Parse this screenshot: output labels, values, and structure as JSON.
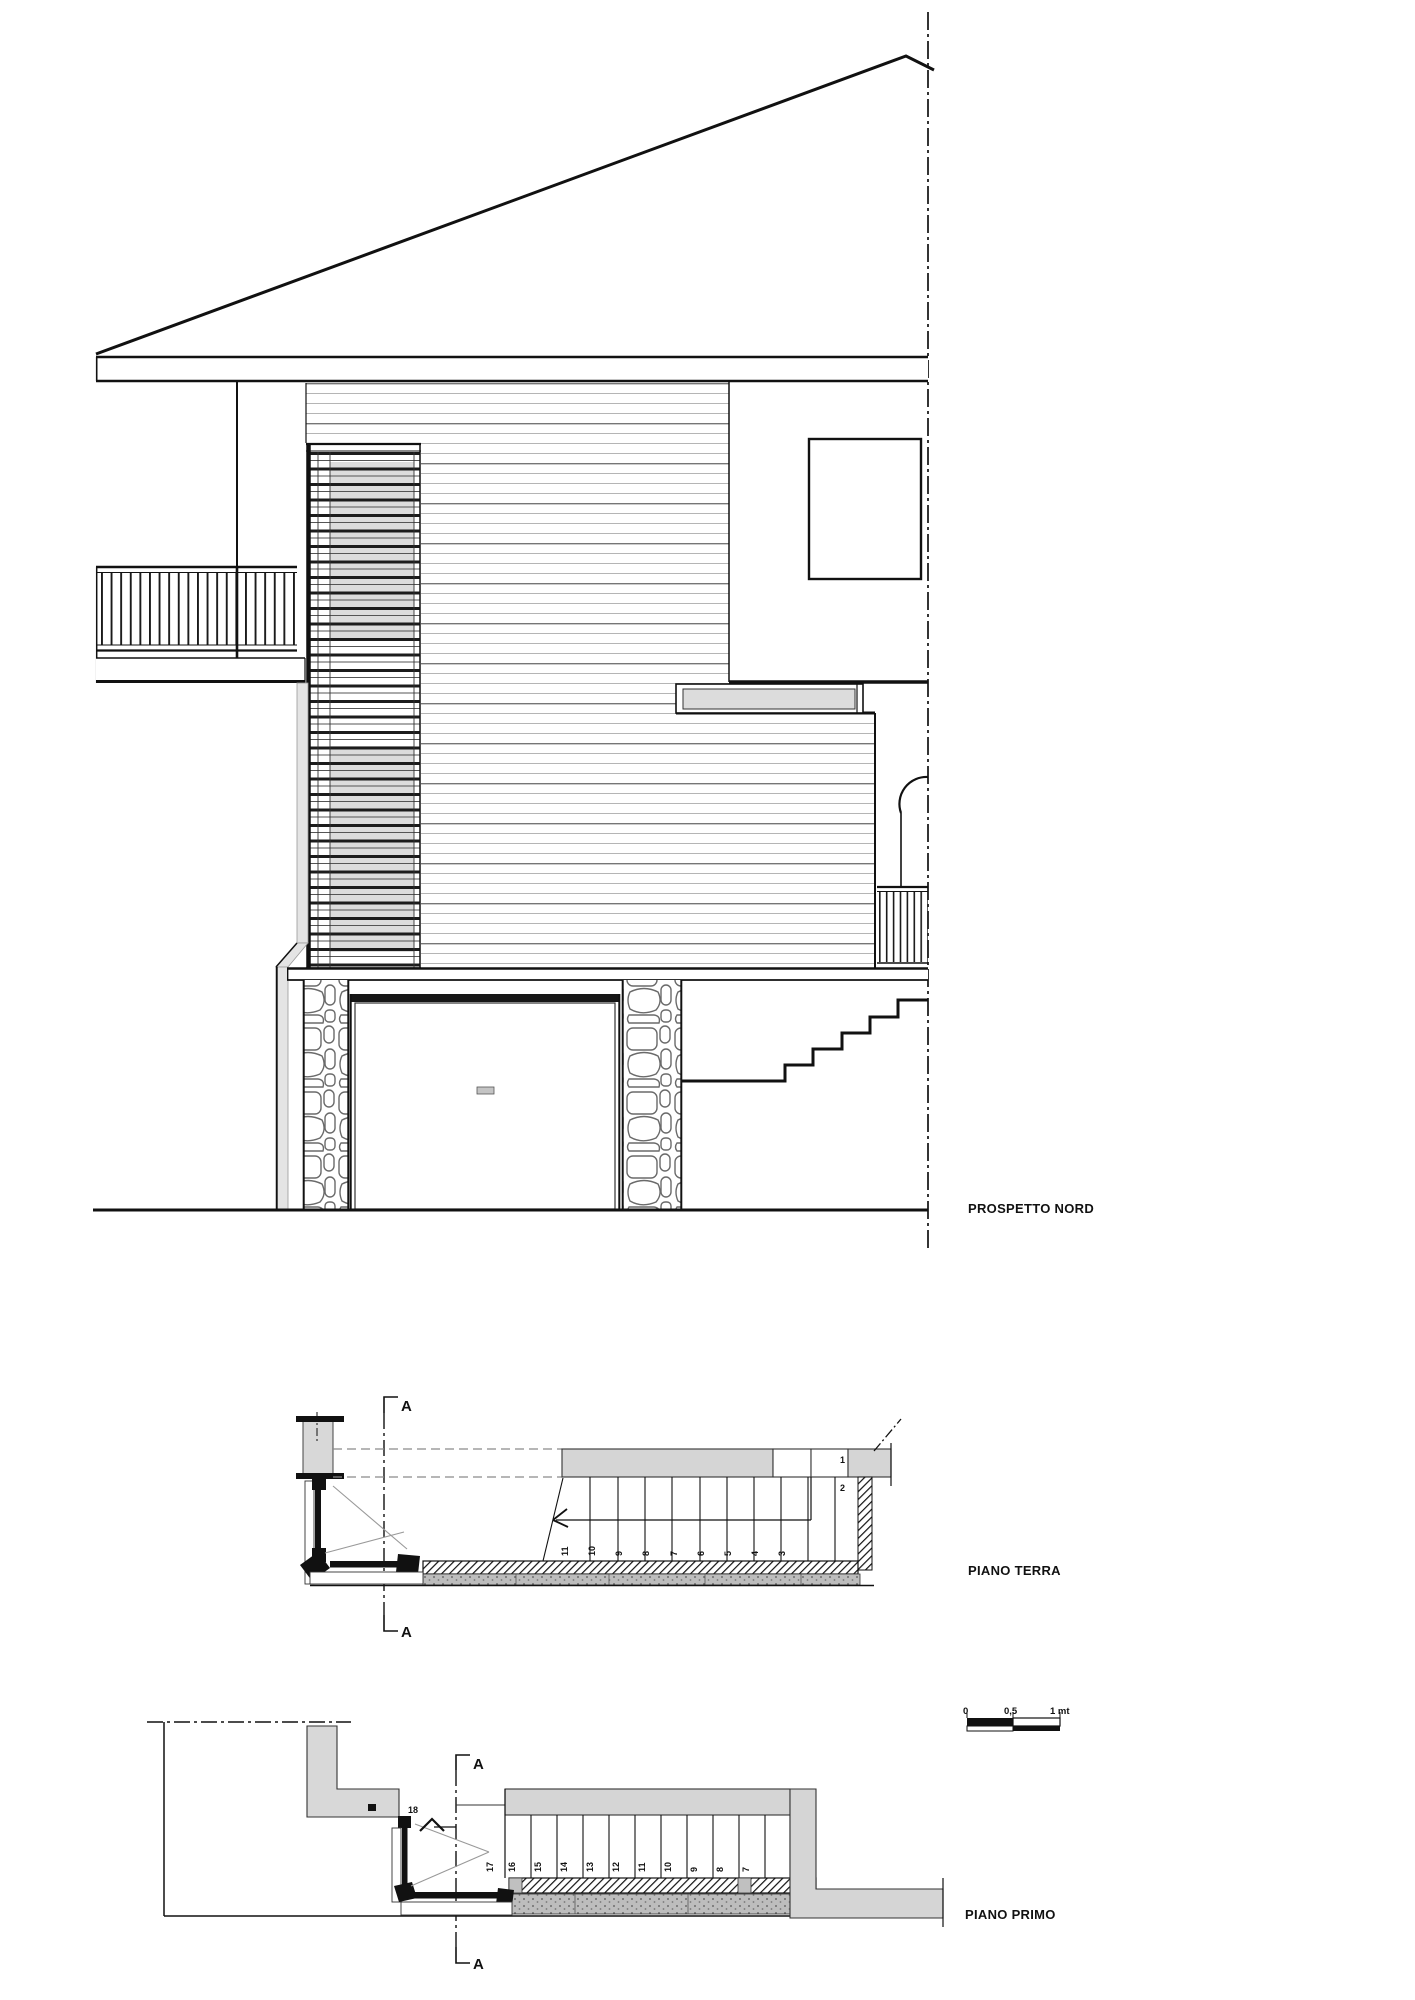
{
  "drawing": {
    "elevation": {
      "label": "PROSPETTO NORD"
    },
    "plan_ground": {
      "label": "PIANO TERRA",
      "section_marker": "A",
      "top_numbers": [
        "1",
        "2"
      ],
      "step_numbers": [
        "11",
        "10",
        "9",
        "8",
        "7",
        "6",
        "5",
        "4",
        "3"
      ]
    },
    "plan_first": {
      "label": "PIANO PRIMO",
      "section_marker": "A",
      "top_step": "18",
      "step_numbers": [
        "17",
        "16",
        "15",
        "14",
        "13",
        "12",
        "11",
        "10",
        "9",
        "8",
        "7"
      ]
    },
    "scale_bar": {
      "zero": "0",
      "half": "0,5",
      "one": "1 mt"
    },
    "colors": {
      "line": "#111111",
      "siding_line_dark": "#6e6e6e",
      "siding_line_light": "#b5b5b5",
      "gray_fill": "#d5d5d5",
      "glass_gray": "#dcdcdc",
      "downpipe_gray": "#e4e4e4"
    }
  }
}
